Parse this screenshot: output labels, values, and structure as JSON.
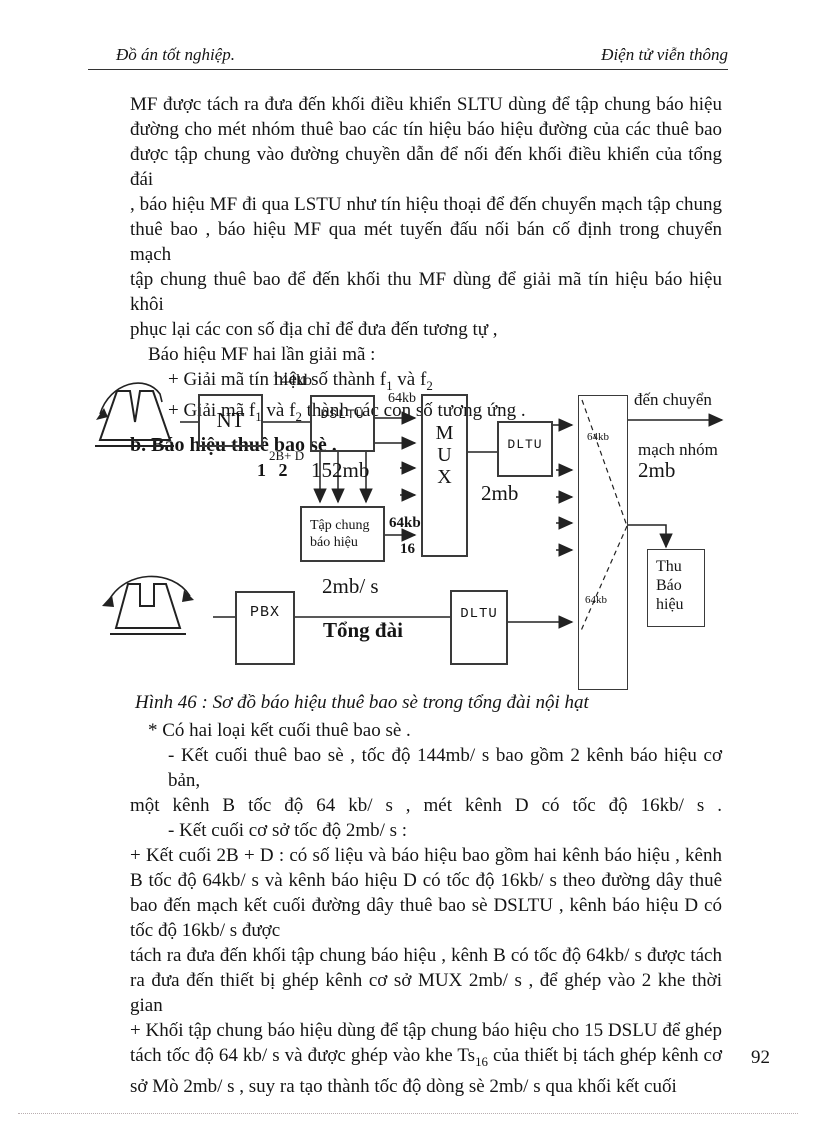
{
  "header": {
    "left": "Đồ án tốt nghiệp.",
    "right": "Điện tử viễn thông"
  },
  "body1": {
    "lines": [
      "MF được tách ra đưa đến khối điều khiển SLTU dùng để tập chung báo hiệu",
      "đường cho mét nhóm thuê bao các tín hiệu báo hiệu đường của các thuê bao",
      "được tập chung vào đường chuyền dẫn để nối đến khối điều khiển của tổng đái",
      ", báo hiệu MF đi qua LSTU như tín hiệu thoại để đến chuyển mạch tập chung",
      "thuê bao , báo hiệu MF qua mét tuyến đấu nối bán cố định trong chuyển mạch",
      "tập chung thuê bao để đến khối thu MF dùng để giải mã tín hiệu báo hiệu khôi",
      "phục lại các con số địa chỉ để đưa đến tương tự ,"
    ],
    "intro": "Báo hiệu MF hai lần giải mã :",
    "i1a": "+ Giải mã tín hiệu số thành f",
    "i1s1": "1",
    "i1b": " và f",
    "i1s2": "2",
    "i2a": "+ Giải mã f",
    "i2s1": "1",
    "i2b": " và f",
    "i2s2": "2",
    "i2c": " thành các con số tương ứng ."
  },
  "heading_b": "b. Báo hiệu thuê bao sè .",
  "diagram": {
    "boxes": {
      "nt": "NT",
      "dsltu": "DSLTU",
      "mux": "M\nU\nX",
      "dltu1": "DLTU",
      "tap_chung": "Tập chung\nbáo hiệu",
      "pbx": "PBX",
      "dltu2": "DLTU",
      "thu_bao_hieu": "Thu\nBáo\nhiệu"
    },
    "labels": {
      "kb144": "144kb",
      "kb64_top": "64kb",
      "b2d": "2B+ D",
      "ch12": "1 2",
      "mb152": "152mb",
      "kb64_mid": "64kb",
      "ch16": "16",
      "mb2": "2mb",
      "kb64_sw_top": "64kb",
      "kb64_sw_bot": "64kb",
      "den_chuyen": "đến chuyển",
      "mach_nhom": "mạch nhóm",
      "mb2_right": "2mb",
      "mb2s": "2mb/ s",
      "tong_dai": "Tổng đài"
    }
  },
  "caption": "Hình 46 : Sơ đồ báo hiệu thuê bao sè trong tổng đài nội hạt",
  "body2": {
    "l1": "* Có hai loại kết cuối thuê bao sè .",
    "l2": "- Kết cuối thuê bao sè , tốc độ 144mb/ s bao gồm 2 kênh báo hiệu cơ bản,",
    "l3": "một kênh B tốc độ 64 kb/ s , mét kênh D có tốc độ 16kb/ s .",
    "l4": "- Kết cuối cơ sở tốc độ 2mb/ s :",
    "l5": "+ Kết cuối 2B + D : có số liệu và báo hiệu bao gồm hai kênh báo hiệu , kênh",
    "l6": "B tốc độ 64kb/ s và kênh báo hiệu D có tốc độ 16kb/ s theo đường dây thuê",
    "l7": "bao đến mạch kết cuối đường dây thuê bao sè DSLTU , kênh báo hiệu D có",
    "l8": "tốc độ 16kb/ s được",
    "l9": "tách ra đưa đến khối tập chung báo hiệu , kênh B có tốc độ 64kb/ s được tách",
    "l10": "ra đưa đến thiết bị ghép kênh cơ sở MUX 2mb/ s , để ghép vào 2 khe thời gian",
    "l11": "+ Khối tập chung báo hiệu dùng để tập chung báo hiệu cho 15 DSLU để ghép",
    "l12a": "tách tốc độ 64 kb/ s và được ghép vào khe Ts",
    "l12sub": "16",
    "l12b": " của thiết bị tách ghép kênh cơ",
    "l13": "sở Mò 2mb/ s , suy ra tạo thành tốc độ dòng sè 2mb/ s qua khối kết cuối"
  },
  "page_number": "92"
}
